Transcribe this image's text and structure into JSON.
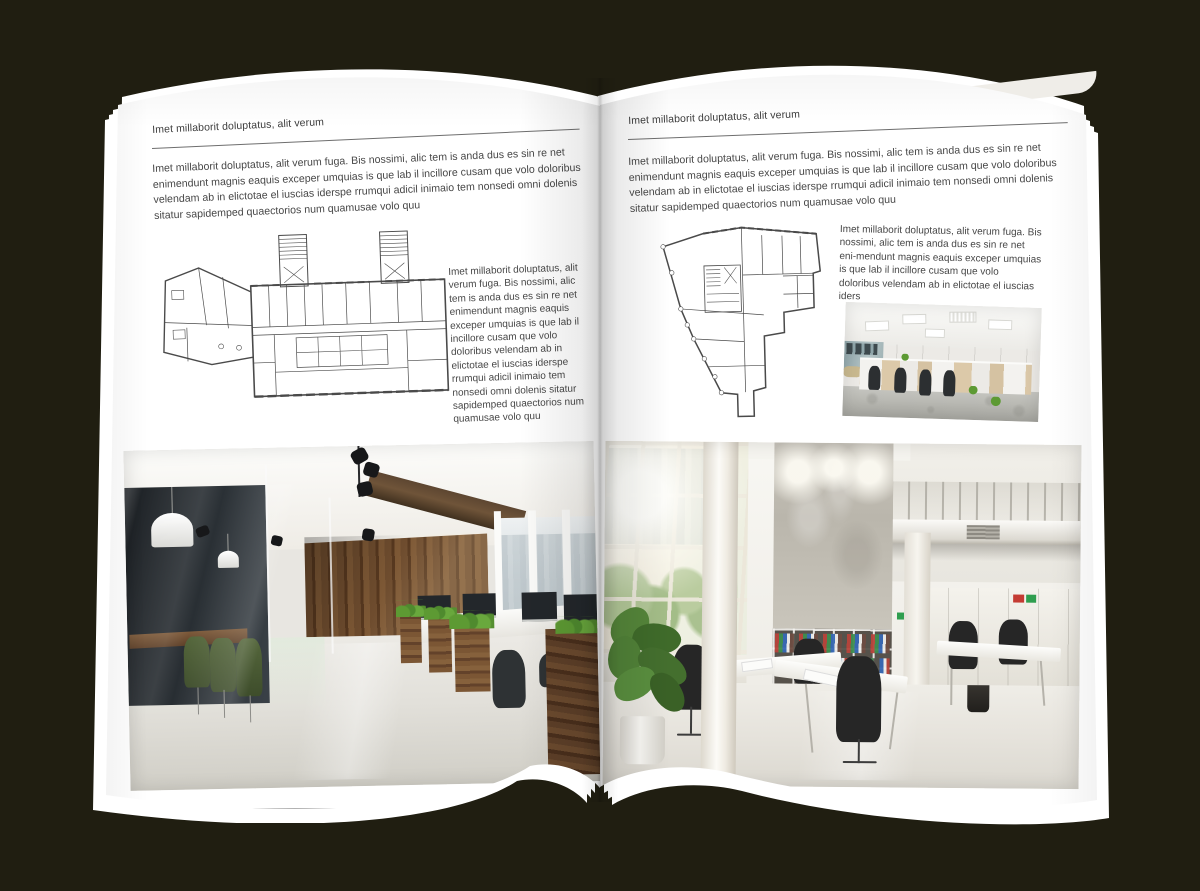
{
  "scene": {
    "type": "open-magazine-mockup",
    "background_color": "#201e11",
    "paper_color": "#ffffff",
    "text_color": "#474747"
  },
  "left_page": {
    "header": "Imet millaborit doluptatus, alit verum",
    "intro": "Imet millaborit doluptatus, alit verum fuga. Bis nossimi, alic tem is anda dus es sin re net enimendunt magnis eaquis exceper umquias is que lab il incillore cusam que volo doloribus velendam ab in elictotae el iuscias iderspe rrumqui adicil inimaio tem nonsedi omni dolenis sitatur sapidemped quaectorios num quamusae volo quu",
    "column_text": "Imet millaborit doluptatus, alit verum fuga. Bis nossimi, alic tem is anda dus es sin re net enimendunt magnis eaquis exceper umquias is que lab il incillore cusam que volo doloribus velendam ab in elictotae el iuscias iderspe rrumqui adicil inimaio tem nonsedi omni dolenis sitatur sapidemped quaectorios num quamusae volo quu",
    "figures": {
      "floor_plan": "architectural-floor-plan-line-drawing",
      "photo": "office-interior-with-wood-wall-glass-meeting-room-and-green-chairs"
    }
  },
  "right_page": {
    "header": "Imet millaborit doluptatus, alit verum",
    "intro": "Imet millaborit doluptatus, alit verum fuga. Bis nossimi, alic tem is anda dus es sin re net enimendunt magnis eaquis exceper umquias is que lab il incillore cusam que volo doloribus velendam ab in elictotae el iuscias iderspe rrumqui adicil inimaio tem nonsedi omni dolenis sitatur sapidemped quaectorios num quamusae volo quu",
    "column_text": "Imet millaborit doluptatus, alit verum fuga. Bis nossimi, alic tem is anda dus es sin re net eni-mendunt magnis eaquis exceper umquias is que lab il incillore cusam que volo doloribus velendam ab in elictotae el iuscias iders",
    "figures": {
      "floor_plan": "architectural-floor-plan-line-drawing",
      "photo_small": "white-open-plan-office-with-desk-rows",
      "photo_large": "tall-white-office-atrium-with-plant-bookshelves-and-desks"
    }
  }
}
